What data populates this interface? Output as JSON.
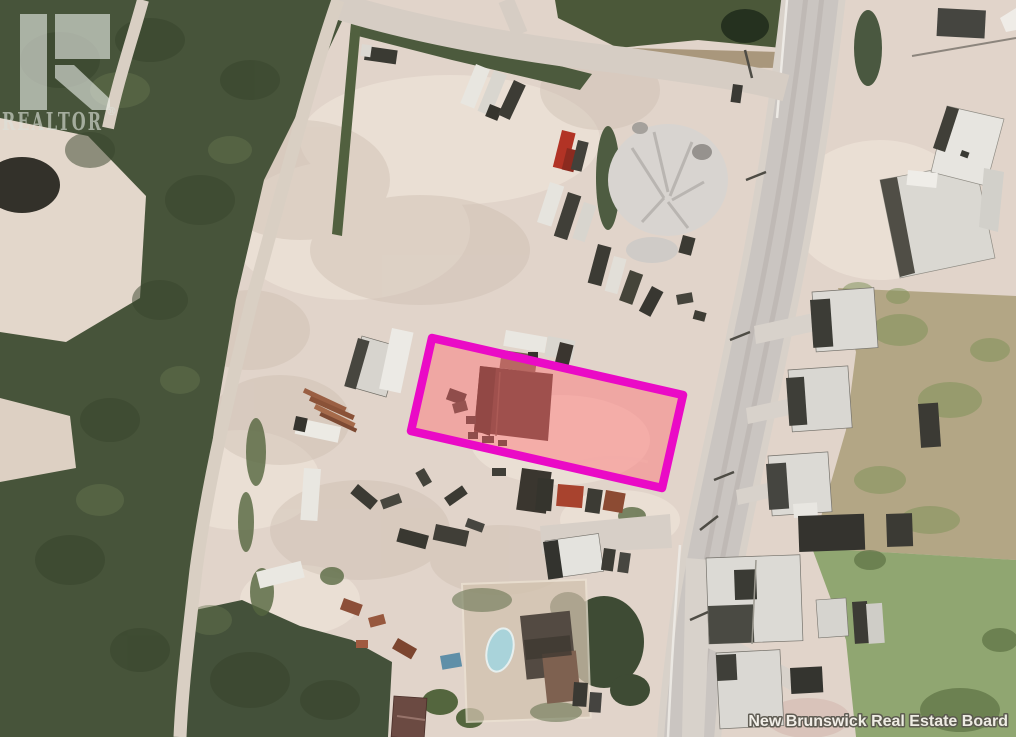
{
  "meta": {
    "kind": "aerial-property-photo",
    "width_px": 1016,
    "height_px": 737,
    "description": "Aerial photo of a gravel equipment yard beside a two-lane road; a rectangular lot containing a dark-roofed building is outlined in magenta."
  },
  "watermark": {
    "brand": "REALTOR",
    "registered_symbol": "®",
    "color": "#dde2da"
  },
  "attribution": {
    "text": "New Brunswick Real Estate Board",
    "text_color": "#f4f1ea"
  },
  "parcel_highlight": {
    "points": "432,338 683,395 662,488 411,431",
    "outline_color": "#ea0ac6",
    "outline_width": "8.5",
    "fill_color": "rgba(255,116,120,0.47)"
  },
  "palette": {
    "bare_ground": "#e1d4ca",
    "forest": "#47543a",
    "grass": "#90a671",
    "dry_grass": "#b3a685",
    "road": "#cac5c1",
    "roof_light": "#dcdad5",
    "roof_dark": "#3c3c36",
    "pool_water": "#a9d3da"
  }
}
